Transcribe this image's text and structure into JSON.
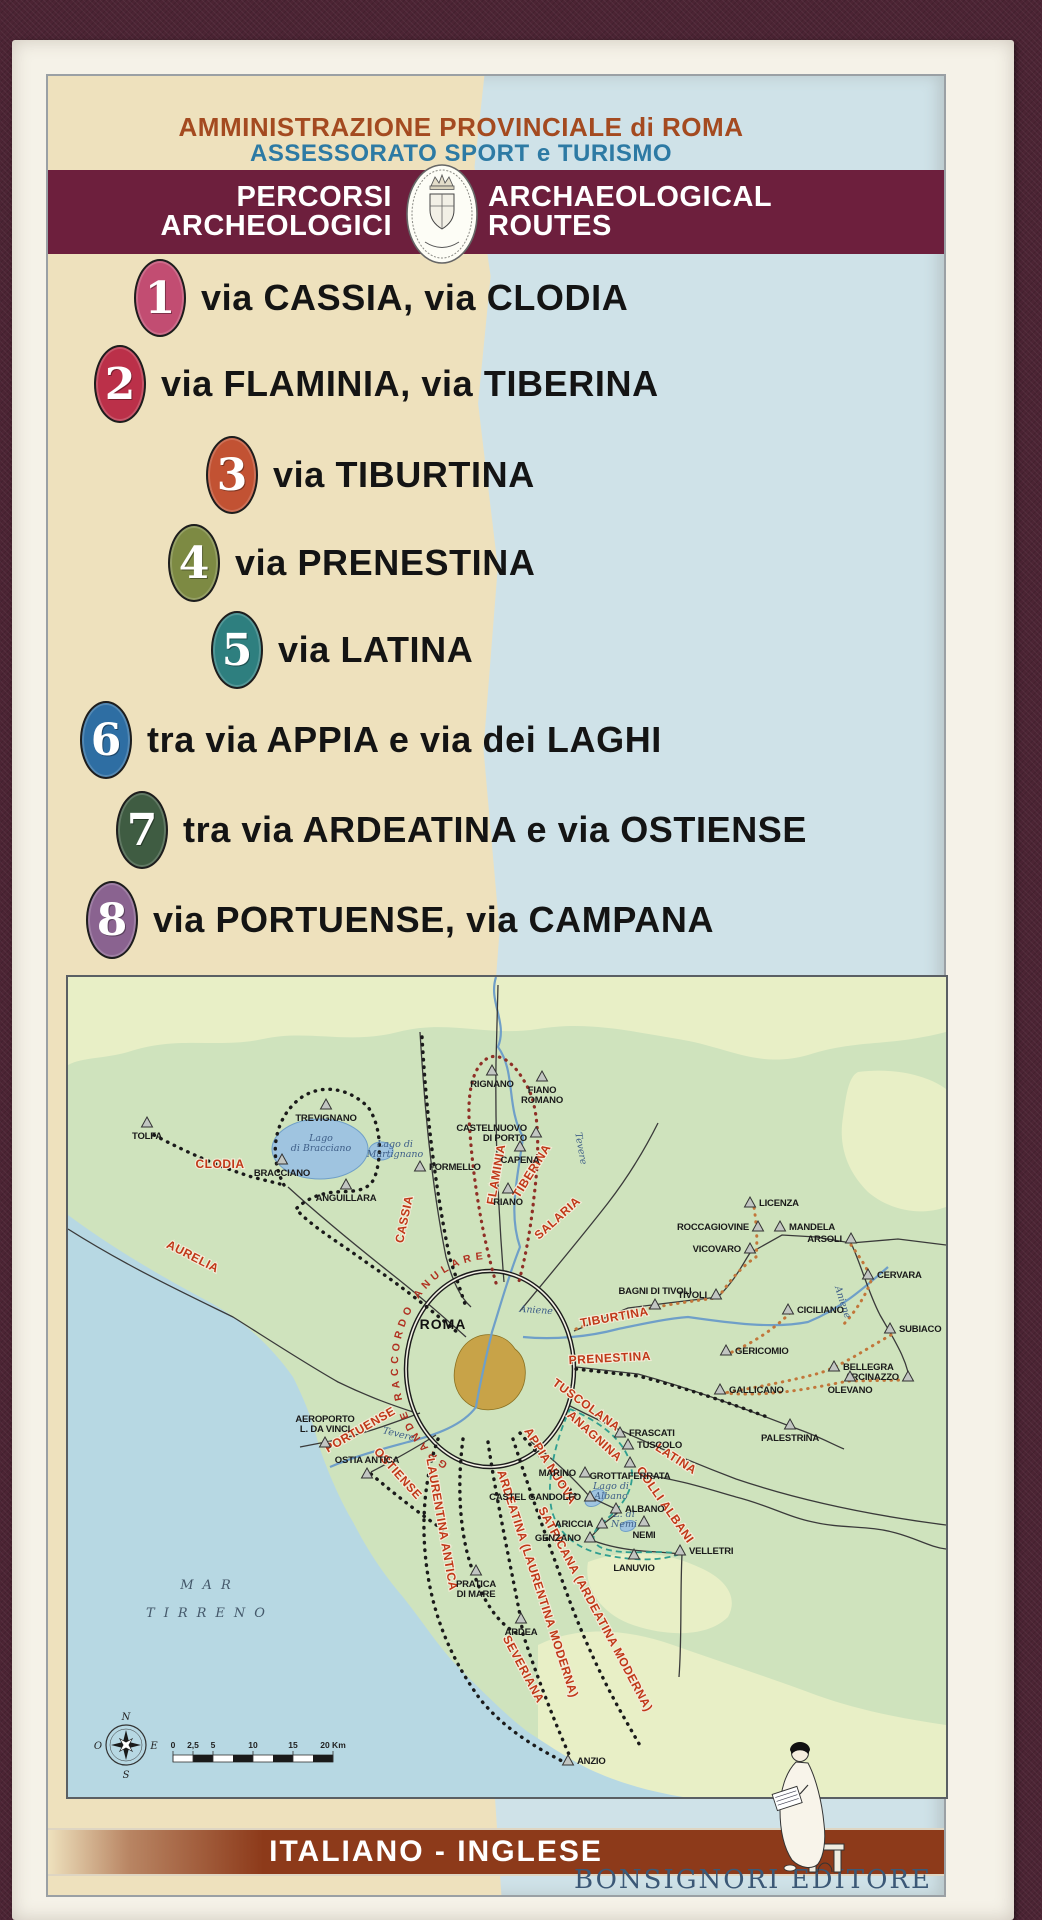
{
  "cover": {
    "header": {
      "line1": "AMMINISTRAZIONE PROVINCIALE di ROMA",
      "line2": "ASSESSORATO SPORT e TURISMO"
    },
    "banner": {
      "it_line1": "PERCORSI",
      "it_line2": "ARCHEOLOGICI",
      "en_line1": "ARCHAEOLOGICAL",
      "en_line2": "ROUTES",
      "crest_icon": "provincia-di-roma-coat-of-arms"
    },
    "routes": [
      {
        "number": "1",
        "label": "via CASSIA, via CLODIA",
        "badge_color": "#c24d72",
        "x": 86,
        "y": 183
      },
      {
        "number": "2",
        "label": "via FLAMINIA, via TIBERINA",
        "badge_color": "#bb3049",
        "x": 46,
        "y": 269
      },
      {
        "number": "3",
        "label": "via TIBURTINA",
        "badge_color": "#c25233",
        "x": 158,
        "y": 360
      },
      {
        "number": "4",
        "label": "via PRENESTINA",
        "badge_color": "#7d8a43",
        "x": 120,
        "y": 448
      },
      {
        "number": "5",
        "label": "via LATINA",
        "badge_color": "#2e7f7f",
        "x": 163,
        "y": 535
      },
      {
        "number": "6",
        "label": "tra via APPIA e via dei LAGHI",
        "badge_color": "#2e6ea3",
        "x": 32,
        "y": 625
      },
      {
        "number": "7",
        "label": "tra via ARDEATINA e via OSTIENSE",
        "badge_color": "#3f5c42",
        "x": 68,
        "y": 715
      },
      {
        "number": "8",
        "label": "via PORTUENSE, via CAMPANA",
        "badge_color": "#8a6390",
        "x": 38,
        "y": 805
      }
    ],
    "footer": {
      "language_band": "ITALIANO - INGLESE",
      "publisher": "BONSIGNORI EDITORE",
      "logo_icon": "seated-scribe"
    },
    "colors": {
      "banner": "#6d1f3d",
      "header_line1": "#a44a20",
      "header_line2": "#2d7aa4",
      "language_band": "#8d3a1a",
      "publisher_text": "#3b5876",
      "cream_bg": "#eee1bd",
      "blue_bg": "#cfe2e8"
    }
  },
  "map": {
    "roma_label": "ROMA",
    "ring_road_label": "GRANDE RACCORDO ANULARE",
    "sea_label_line1": "MAR",
    "sea_label_line2": "TIRRENO",
    "compass": {
      "n": "N",
      "e": "E",
      "s": "S",
      "o": "O"
    },
    "scale_ticks": [
      {
        "t": "0",
        "o": 0
      },
      {
        "t": "2,5",
        "o": 20
      },
      {
        "t": "5",
        "o": 40
      },
      {
        "t": "10",
        "o": 80
      },
      {
        "t": "15",
        "o": 120
      },
      {
        "t": "20 Km",
        "o": 160
      }
    ],
    "towns": [
      {
        "n": "TOLFA",
        "x": 79,
        "y": 146,
        "s": "b"
      },
      {
        "n": "TREVIGNANO",
        "x": 258,
        "y": 128,
        "s": "b"
      },
      {
        "n": "BRACCIANO",
        "x": 214,
        "y": 183,
        "s": "b"
      },
      {
        "n": "ANGUILLARA",
        "x": 278,
        "y": 208,
        "s": "b"
      },
      {
        "n": "FORMELLO",
        "x": 352,
        "y": 190,
        "s": "r"
      },
      {
        "n": "RIGNANO",
        "x": 424,
        "y": 94,
        "s": "b"
      },
      {
        "n": [
          "FIANO",
          "ROMANO"
        ],
        "x": 474,
        "y": 100,
        "s": "b"
      },
      {
        "n": [
          "CASTELNUOVO",
          "DI PORTO"
        ],
        "x": 468,
        "y": 156,
        "s": "l"
      },
      {
        "n": "CAPENA",
        "x": 452,
        "y": 170,
        "s": "b"
      },
      {
        "n": "RIANO",
        "x": 440,
        "y": 212,
        "s": "b"
      },
      {
        "n": "LICENZA",
        "x": 682,
        "y": 226,
        "s": "r"
      },
      {
        "n": "ROCCAGIOVINE",
        "x": 690,
        "y": 250,
        "s": "l"
      },
      {
        "n": "MANDELA",
        "x": 712,
        "y": 250,
        "s": "r"
      },
      {
        "n": "ARSOLI",
        "x": 783,
        "y": 262,
        "s": "l"
      },
      {
        "n": "VICOVARO",
        "x": 682,
        "y": 272,
        "s": "l"
      },
      {
        "n": "CERVARA",
        "x": 800,
        "y": 298,
        "s": "r"
      },
      {
        "n": "BAGNI DI TIVOLI",
        "x": 587,
        "y": 328,
        "s": "a"
      },
      {
        "n": "TIVOLI",
        "x": 648,
        "y": 318,
        "s": "l"
      },
      {
        "n": "CICILIANO",
        "x": 720,
        "y": 333,
        "s": "r"
      },
      {
        "n": "SUBIACO",
        "x": 822,
        "y": 352,
        "s": "r"
      },
      {
        "n": "GERICOMIO",
        "x": 658,
        "y": 374,
        "s": "r"
      },
      {
        "n": "BELLEGRA",
        "x": 766,
        "y": 390,
        "s": "r"
      },
      {
        "n": "ARCINAZZO",
        "x": 840,
        "y": 400,
        "s": "l"
      },
      {
        "n": "OLEVANO",
        "x": 782,
        "y": 400,
        "s": "b"
      },
      {
        "n": "GALLICANO",
        "x": 652,
        "y": 413,
        "s": "r"
      },
      {
        "n": "PALESTRINA",
        "x": 722,
        "y": 448,
        "s": "b"
      },
      {
        "n": "FRASCATI",
        "x": 552,
        "y": 456,
        "s": "r"
      },
      {
        "n": "TUSCOLO",
        "x": 560,
        "y": 468,
        "s": "r"
      },
      {
        "n": "GROTTAFERRATA",
        "x": 562,
        "y": 486,
        "s": "b"
      },
      {
        "n": "MARINO",
        "x": 517,
        "y": 496,
        "s": "l"
      },
      {
        "n": "CASTEL GANDOLFO",
        "x": 522,
        "y": 520,
        "s": "l"
      },
      {
        "n": "ALBANO",
        "x": 548,
        "y": 532,
        "s": "r"
      },
      {
        "n": "ARICCIA",
        "x": 534,
        "y": 547,
        "s": "l"
      },
      {
        "n": "GENZANO",
        "x": 522,
        "y": 561,
        "s": "l"
      },
      {
        "n": "NEMI",
        "x": 576,
        "y": 545,
        "s": "b"
      },
      {
        "n": "LANUVIO",
        "x": 566,
        "y": 578,
        "s": "b"
      },
      {
        "n": "VELLETRI",
        "x": 612,
        "y": 574,
        "s": "r"
      },
      {
        "n": [
          "AEROPORTO",
          "L. DA VINCI"
        ],
        "x": 257,
        "y": 466,
        "s": "a"
      },
      {
        "n": "OSTIA ANTICA",
        "x": 299,
        "y": 497,
        "s": "a"
      },
      {
        "n": [
          "PRATICA",
          "DI MARE"
        ],
        "x": 408,
        "y": 594,
        "s": "b"
      },
      {
        "n": "ARDEA",
        "x": 453,
        "y": 642,
        "s": "b"
      },
      {
        "n": "ANZIO",
        "x": 500,
        "y": 784,
        "s": "r"
      }
    ],
    "road_labels": [
      {
        "n": "CLODIA",
        "x": 152,
        "y": 191,
        "r": 0
      },
      {
        "n": "CASSIA",
        "x": 340,
        "y": 243,
        "r": -78
      },
      {
        "n": "AURELIA",
        "x": 123,
        "y": 283,
        "r": 27
      },
      {
        "n": "FLAMINIA",
        "x": 432,
        "y": 198,
        "r": -80
      },
      {
        "n": "TIBERINA",
        "x": 467,
        "y": 196,
        "r": -58
      },
      {
        "n": "SALARIA",
        "x": 492,
        "y": 244,
        "r": -42
      },
      {
        "n": "TIBURTINA",
        "x": 547,
        "y": 344,
        "r": -10
      },
      {
        "n": "PRENESTINA",
        "x": 542,
        "y": 385,
        "r": -3
      },
      {
        "n": "TUSCOLANA",
        "x": 516,
        "y": 431,
        "r": 36
      },
      {
        "n": "ANAGNINA",
        "x": 524,
        "y": 462,
        "r": 42
      },
      {
        "n": "LATINA",
        "x": 606,
        "y": 485,
        "r": 33
      },
      {
        "n": "COLLI ALBANI",
        "x": 594,
        "y": 530,
        "r": 55
      },
      {
        "n": "APPIA NUOVA",
        "x": 479,
        "y": 491,
        "r": 58
      },
      {
        "n": "PORTUENSE",
        "x": 294,
        "y": 456,
        "r": -30
      },
      {
        "n": "OSTIENSE",
        "x": 327,
        "y": 499,
        "r": 48
      },
      {
        "n": "LAURENTINA ANTICA",
        "x": 370,
        "y": 548,
        "r": 80
      },
      {
        "n": "ARDEATINA (LAURENTINA MODERNA)",
        "x": 466,
        "y": 608,
        "r": 72
      },
      {
        "n": "SATRICANA (ARDEATINA MODERNA)",
        "x": 524,
        "y": 634,
        "r": 62
      },
      {
        "n": "SEVERIANA",
        "x": 452,
        "y": 694,
        "r": 62
      }
    ],
    "water_labels": [
      {
        "n": [
          "Lago",
          "di Bracciano"
        ],
        "x": 253,
        "y": 164,
        "r": 0
      },
      {
        "n": [
          "Lago di",
          "Martignano"
        ],
        "x": 327,
        "y": 170,
        "r": 0
      },
      {
        "n": "Tevere",
        "x": 510,
        "y": 172,
        "r": 80
      },
      {
        "n": "Tevere",
        "x": 330,
        "y": 460,
        "r": 14
      },
      {
        "n": "Aniene",
        "x": 468,
        "y": 336,
        "r": 4
      },
      {
        "n": "Aniene",
        "x": 772,
        "y": 326,
        "r": 72
      },
      {
        "n": [
          "Lago di",
          "Albano"
        ],
        "x": 543,
        "y": 512,
        "r": 0
      },
      {
        "n": [
          "L. di",
          "Nemi"
        ],
        "x": 556,
        "y": 540,
        "r": 0
      }
    ]
  }
}
